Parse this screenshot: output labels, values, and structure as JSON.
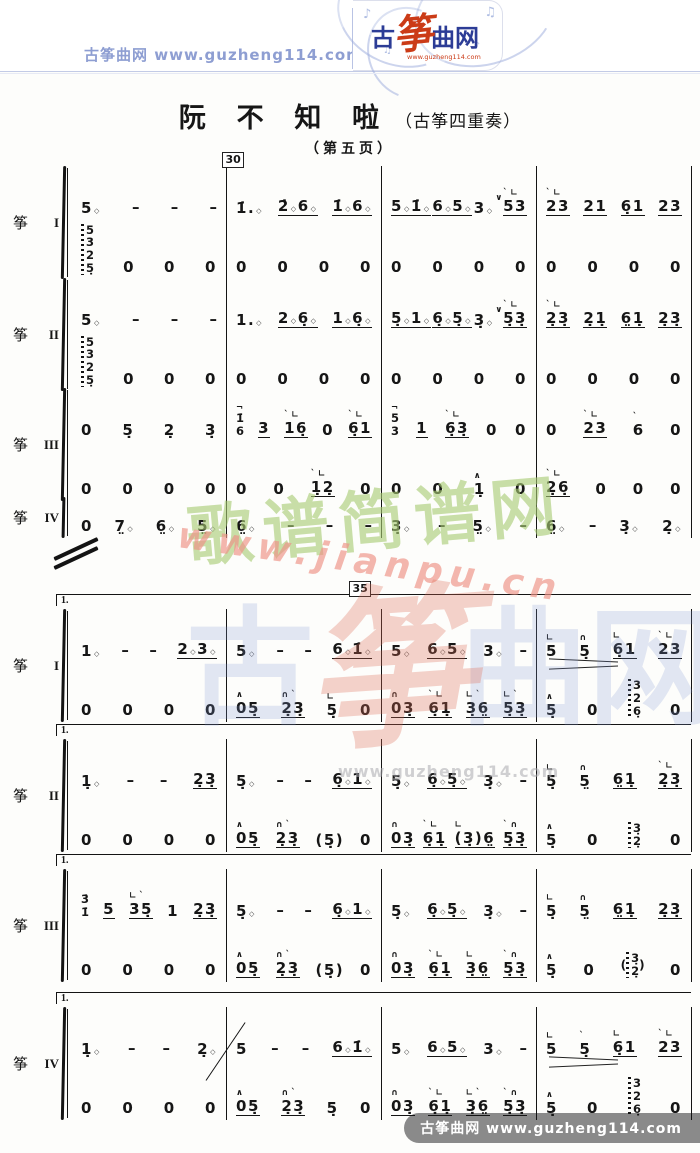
{
  "header": {
    "site_label": "古筝曲网",
    "site_url": "www.guzheng114.com",
    "logo": {
      "char_gu": "古",
      "char_zheng": "筝",
      "char_quwang": "曲网",
      "url": "www.guzheng114.com"
    }
  },
  "title": {
    "main": "阮 不 知 啦",
    "paren": "（古筝四重奏）",
    "subtitle": "（第五页）"
  },
  "marks": {
    "m30": "30",
    "m35": "35"
  },
  "labels": {
    "zheng": "筝",
    "numerals": [
      "I",
      "II",
      "III",
      "IV"
    ]
  },
  "watermarks": {
    "jianpu_name": "歌谱简谱网",
    "jianpu_url": "www.jianpu.cn",
    "guzheng_chars": [
      "古",
      "筝",
      "曲",
      "网"
    ],
    "guzheng_url": "www.guzheng114.com"
  },
  "footer": {
    "site_label": "古筝曲网",
    "site_url": "www.guzheng114.com"
  },
  "score": {
    "sections": [
      {
        "systems": [
          {
            "numeral_index": 0,
            "volta": null,
            "lines": [
              [
                {
                  "t": [
                    "5*",
                    "–",
                    "–",
                    "–"
                  ]
                },
                {
                  "t": [
                    "1̇.*",
                    "_2̇*6*",
                    "_1̇*6*"
                  ]
                },
                {
                  "t": [
                    "_5*1̇*",
                    "_6*5*",
                    "3*",
                    "{∨}",
                    "{`∟}_53"
                  ]
                },
                {
                  "t": [
                    "{`∟}_23",
                    "_21",
                    "_6̣1",
                    "_23"
                  ]
                }
              ],
              [
                {
                  "t": [
                    "#5/3/2/5̣~",
                    "0",
                    "0",
                    "0"
                  ]
                },
                {
                  "t": [
                    "0",
                    "0",
                    "0",
                    "0"
                  ]
                },
                {
                  "t": [
                    "0",
                    "0",
                    "0",
                    "0"
                  ]
                },
                {
                  "t": [
                    "0",
                    "0",
                    "0",
                    "0"
                  ]
                }
              ]
            ]
          },
          {
            "numeral_index": 1,
            "volta": null,
            "lines": [
              [
                {
                  "t": [
                    "5*",
                    "–",
                    "–",
                    "–"
                  ]
                },
                {
                  "t": [
                    "1.*",
                    "_2*6̣*",
                    "_1*6̣*"
                  ]
                },
                {
                  "t": [
                    "_5̣*1*",
                    "_6̣*5̣*",
                    "3̣*",
                    "{∨}",
                    "{`∟}_5̣3̣"
                  ]
                },
                {
                  "t": [
                    "{`∟}_2̣3̣",
                    "_2̣1̣",
                    "_6̤1̣",
                    "_2̣3̣"
                  ]
                }
              ],
              [
                {
                  "t": [
                    "#5/3/2/5̣~",
                    "0",
                    "0",
                    "0"
                  ]
                },
                {
                  "t": [
                    "0",
                    "0",
                    "0",
                    "0"
                  ]
                },
                {
                  "t": [
                    "0",
                    "0",
                    "0",
                    "0"
                  ]
                },
                {
                  "t": [
                    "0",
                    "0",
                    "0",
                    "0"
                  ]
                }
              ]
            ]
          },
          {
            "numeral_index": 2,
            "volta": null,
            "lines": [
              [
                {
                  "t": [
                    "0",
                    "5̣",
                    "2̣",
                    "3̣"
                  ]
                },
                {
                  "t": [
                    "{¬}#1̇/6",
                    "_3",
                    "{`∟}_16̣",
                    "0",
                    "{`∟}_6̣1"
                  ]
                },
                {
                  "t": [
                    "{¬}#5/3",
                    "_1",
                    "{`∟}_6̣3̣",
                    "0",
                    "0"
                  ]
                },
                {
                  "t": [
                    "0",
                    "{`∟}_23",
                    "{`}6",
                    "0"
                  ]
                }
              ],
              [
                {
                  "t": [
                    "0",
                    "0",
                    "0",
                    "0"
                  ]
                },
                {
                  "t": [
                    "0",
                    "0",
                    "{`∟}_1̣2̣",
                    "0"
                  ]
                },
                {
                  "t": [
                    "0",
                    "0",
                    "{∧}1̣",
                    "0"
                  ]
                },
                {
                  "t": [
                    "{`∟}_2̣6̣",
                    "0",
                    "0",
                    "0"
                  ]
                }
              ]
            ]
          },
          {
            "numeral_index": 3,
            "volta": null,
            "lines": [
              [
                {
                  "t": [
                    "0",
                    "7̤*",
                    "6̤*",
                    "5̤*"
                  ]
                },
                {
                  "t": [
                    "6̤*",
                    "–",
                    "–",
                    "–"
                  ]
                },
                {
                  "t": [
                    "3̣*",
                    "–",
                    "5̤*",
                    "–"
                  ]
                },
                {
                  "t": [
                    "6̤*",
                    "–",
                    "3̣*",
                    "2̣*"
                  ]
                }
              ]
            ]
          }
        ]
      },
      {
        "systems": [
          {
            "numeral_index": 0,
            "volta": "1.",
            "lines": [
              [
                {
                  "t": [
                    "1*",
                    "–",
                    "–",
                    "_2*3*"
                  ]
                },
                {
                  "t": [
                    "5*",
                    "–",
                    "–",
                    "_6*1̇*"
                  ]
                },
                {
                  "t": [
                    "5*",
                    "_6*5*",
                    "3*",
                    "–"
                  ]
                },
                {
                  "t": [
                    "{∟}5",
                    "{∩}5̣",
                    "{∟}_6̣1",
                    "{`∟}_23"
                  ],
                  "hp": true
                }
              ],
              [
                {
                  "t": [
                    "0",
                    "0",
                    "0",
                    "0"
                  ]
                },
                {
                  "t": [
                    "{∧}_05̣",
                    "{∩`}_2̣3̣",
                    "{∟}5̣",
                    "0"
                  ]
                },
                {
                  "t": [
                    "{∩}_03̣",
                    "{`∟}_6̣1̣",
                    "{∟`}_3̣6̤",
                    "{∟`}_5̣3̣"
                  ]
                },
                {
                  "t": [
                    "{∧}5̣",
                    "0",
                    "#3/2/6̣~",
                    "0"
                  ]
                }
              ]
            ]
          },
          {
            "numeral_index": 1,
            "volta": "1.",
            "lines": [
              [
                {
                  "t": [
                    "1̣*",
                    "–",
                    "–",
                    "_2̣3̣"
                  ]
                },
                {
                  "t": [
                    "5̣*",
                    "–",
                    "–",
                    "_6̣*1*"
                  ]
                },
                {
                  "t": [
                    "5̣*",
                    "_6̣*5̣*",
                    "3̣*",
                    "–"
                  ]
                },
                {
                  "t": [
                    "{∟}5̣",
                    "{∩}5̤",
                    "_6̤1̣",
                    "{`∟}_2̣3̣"
                  ]
                }
              ],
              [
                {
                  "t": [
                    "0",
                    "0",
                    "0",
                    "0"
                  ]
                },
                {
                  "t": [
                    "{∧}_05̣",
                    "{∩`}_2̣3̣",
                    "(5̣)",
                    "0"
                  ]
                },
                {
                  "t": [
                    "{∩}_03̣",
                    "{`∟}_6̣1̣",
                    "{∟}_(3̣)6̤",
                    "{`∩}_5̣3̣"
                  ]
                },
                {
                  "t": [
                    "{∧}5̣",
                    "0",
                    "#3̣/2̣~",
                    "0"
                  ]
                }
              ]
            ]
          },
          {
            "numeral_index": 2,
            "volta": "1.",
            "lines": [
              [
                {
                  "t": [
                    "#3̇/1̇",
                    "_5",
                    "{∟`}_35̣",
                    "1",
                    "_2̣3̣"
                  ]
                },
                {
                  "t": [
                    "5̣*",
                    "–",
                    "–",
                    "_6̣*1*"
                  ]
                },
                {
                  "t": [
                    "5̣*",
                    "_6̣*5̣*",
                    "3̣*",
                    "–"
                  ]
                },
                {
                  "t": [
                    "{∟}5̣",
                    "{∩}5̤",
                    "_6̤1̣",
                    "_2̣3̣"
                  ]
                }
              ],
              [
                {
                  "t": [
                    "0",
                    "0",
                    "0",
                    "0"
                  ]
                },
                {
                  "t": [
                    "{∧}_05̣",
                    "{∩`}_2̣3̣",
                    "(5̣)",
                    "0"
                  ]
                },
                {
                  "t": [
                    "{∩}_03̣",
                    "{`∟}_6̣1̣",
                    "{∟}_3̣6̤",
                    "{`∩}_5̣3̣"
                  ]
                },
                {
                  "t": [
                    "{∧}5̣",
                    "0",
                    "(#3̣/2̣~)",
                    "0"
                  ]
                }
              ]
            ]
          },
          {
            "numeral_index": 3,
            "volta": "1.",
            "gliss": true,
            "lines": [
              [
                {
                  "t": [
                    "1̣*",
                    "–",
                    "–",
                    "2̣*"
                  ]
                },
                {
                  "t": [
                    "5",
                    "–",
                    "–",
                    "_6*1̇*"
                  ]
                },
                {
                  "t": [
                    "5*",
                    "_6*5*",
                    "3*",
                    "–"
                  ]
                },
                {
                  "t": [
                    "{∟}5",
                    "{`}5̣",
                    "{∟}_6̣1",
                    "{`∟}_23"
                  ],
                  "hp": true
                }
              ],
              [
                {
                  "t": [
                    "0",
                    "0",
                    "0",
                    "0"
                  ]
                },
                {
                  "t": [
                    "{∧}_05̣",
                    "{∩`}_2̣3̣",
                    "5̣",
                    "0"
                  ]
                },
                {
                  "t": [
                    "{∩}_03̣",
                    "{`∟}_6̣1̣",
                    "{∟`}_3̣6̤",
                    "{`∩}_5̣3̣"
                  ]
                },
                {
                  "t": [
                    "{∧}5̣",
                    "0",
                    "#3/2/6̣~",
                    "0"
                  ]
                }
              ]
            ]
          }
        ]
      }
    ]
  }
}
